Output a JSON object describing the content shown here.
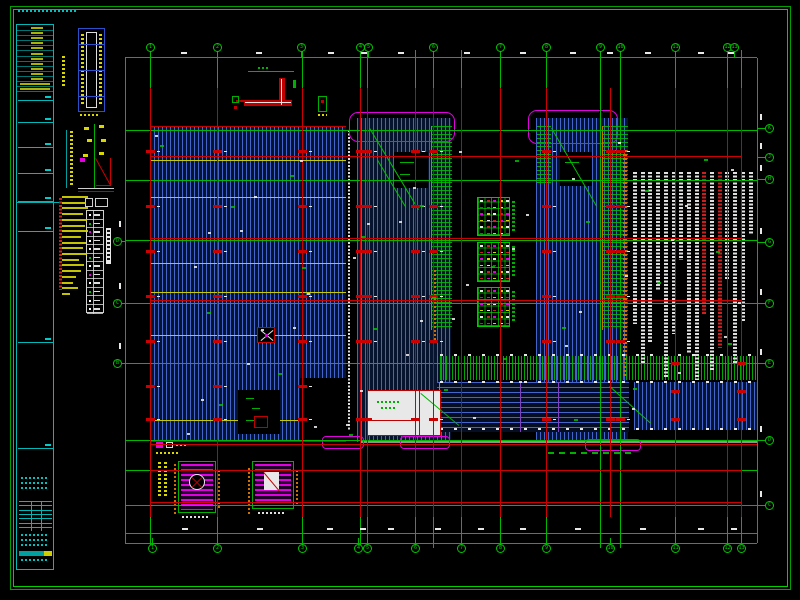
{
  "drawing": {
    "title": "structural floor plan CAD sheet",
    "colors": {
      "background": "#000000",
      "frame": "#00a000",
      "grid_green": "#00b800",
      "grid_red": "#cc0000",
      "hatch_blue": "#4669d2",
      "magenta": "#e000e0",
      "cyan": "#00c0c0",
      "yellow": "#d8d800",
      "orange": "#d07000",
      "white": "#e8e8e8",
      "gray": "#909090"
    },
    "grid": {
      "vertical_x": [
        150,
        217,
        302,
        360,
        367,
        415,
        433,
        461,
        500,
        546,
        600,
        620,
        675,
        727,
        741
      ],
      "red_vertical_x": [
        150,
        217,
        302,
        360,
        367,
        415,
        433,
        461,
        500,
        546,
        610,
        675,
        727,
        741
      ],
      "green_horizontal_y": [
        130,
        180,
        240,
        303,
        363,
        440,
        470,
        505
      ],
      "red_horizontal_y": [
        156,
        238,
        300,
        470,
        502
      ],
      "plan_bottom_red_y": 444,
      "top_bubbles_x": [
        150,
        217,
        301,
        360,
        368,
        433,
        500,
        546,
        600,
        620,
        675,
        727,
        734
      ],
      "top_bubble_labels": [
        "1",
        "2",
        "3",
        "4",
        "5",
        "6",
        "7",
        "8",
        "9",
        "10",
        "11",
        "12",
        "13"
      ],
      "bottom_bubbles_x": [
        152,
        217,
        302,
        358,
        367,
        415,
        461,
        500,
        546,
        610,
        675,
        727,
        741
      ],
      "bottom_bubble_labels": [
        "1",
        "2",
        "3",
        "4",
        "5",
        "6",
        "7",
        "8",
        "9",
        "10",
        "11",
        "12",
        "13"
      ],
      "left_bubbles_y": [
        241,
        303,
        363
      ],
      "left_bubble_labels": [
        "D",
        "C",
        "B"
      ],
      "right_bubbles_y": [
        128,
        157,
        179,
        242,
        303,
        363,
        440,
        505
      ],
      "right_bubble_labels": [
        "K",
        "J",
        "H",
        "G",
        "F",
        "E",
        "D",
        "C"
      ]
    },
    "region_a": {
      "yellow_lines_y": [
        160,
        197,
        263,
        292,
        335,
        420
      ],
      "beam_rows_y": [
        150,
        205,
        250,
        295,
        340,
        385,
        418
      ],
      "beam_cols_x": [
        150,
        217,
        302
      ]
    },
    "region_b": {
      "beam_rows_y": [
        150,
        205,
        250,
        295,
        340,
        418
      ],
      "beam_cols_x": [
        360,
        367,
        415,
        433
      ]
    },
    "region_c": {
      "beam_rows_y": [
        150,
        205,
        250,
        295,
        340,
        418
      ],
      "beam_cols_x": [
        546,
        610,
        620
      ]
    },
    "band_markers": {
      "cols_x": [
        675,
        741
      ],
      "rows_y": [
        362,
        390,
        418
      ]
    },
    "center_tables": {
      "count": 3,
      "rows": 6,
      "cols": 5,
      "cell_colors": [
        "#e8e8e8",
        "#cc2020",
        "#e000e0",
        "#d8d800"
      ]
    },
    "legend_table": {
      "rows": 12,
      "cols": 2
    },
    "left_notes_line_widths": [
      26,
      24,
      26,
      21,
      25,
      23,
      26,
      19,
      24,
      21,
      25,
      17,
      22,
      19,
      14,
      11,
      16,
      8
    ],
    "right_notes_columns": [
      {
        "h": 152,
        "c": "w"
      },
      {
        "h": 192,
        "c": "w"
      },
      {
        "h": 170,
        "c": "w"
      },
      {
        "h": 118,
        "c": "w"
      },
      {
        "h": 205,
        "c": "w"
      },
      {
        "h": 162,
        "c": "w"
      },
      {
        "h": 88,
        "c": "w"
      },
      {
        "h": 182,
        "c": "w"
      },
      {
        "h": 208,
        "c": "w"
      },
      {
        "h": 142,
        "c": "r"
      },
      {
        "h": 198,
        "c": "w"
      },
      {
        "h": 176,
        "c": "r"
      },
      {
        "h": 108,
        "c": "w"
      },
      {
        "h": 192,
        "c": "w"
      },
      {
        "h": 150,
        "c": "w"
      },
      {
        "h": 62,
        "c": "w"
      }
    ],
    "title_strip": {
      "header_rows": 13,
      "mini_table_rows": 7
    }
  }
}
